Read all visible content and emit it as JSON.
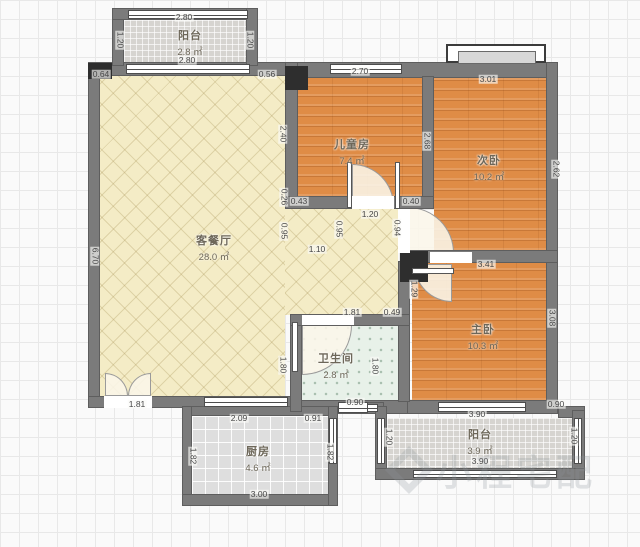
{
  "plan": {
    "title": "户型图",
    "watermark": {
      "text": "小程宅配"
    },
    "rooms": [
      {
        "name": "客餐厅",
        "area": "28.0 ㎡",
        "x": 214,
        "y": 232
      },
      {
        "name": "儿童房",
        "area": "7.4 ㎡",
        "x": 352,
        "y": 136
      },
      {
        "name": "次卧",
        "area": "10.2 ㎡",
        "x": 489,
        "y": 152
      },
      {
        "name": "主卧",
        "area": "10.3 ㎡",
        "x": 483,
        "y": 321
      },
      {
        "name": "卫生间",
        "area": "2.8 ㎡",
        "x": 336,
        "y": 350
      },
      {
        "name": "厨房",
        "area": "4.6 ㎡",
        "x": 258,
        "y": 443
      },
      {
        "name": "阳台",
        "area": "2.8 ㎡",
        "x": 190,
        "y": 27
      },
      {
        "name": "阳台",
        "area": "3.9 ㎡",
        "x": 480,
        "y": 426
      }
    ],
    "dims": [
      {
        "t": "2.80",
        "x": 184,
        "y": 17
      },
      {
        "t": "2.80",
        "x": 187,
        "y": 60
      },
      {
        "t": "1.20",
        "x": 120,
        "y": 40,
        "v": 1
      },
      {
        "t": "1.20",
        "x": 250,
        "y": 40,
        "v": 1
      },
      {
        "t": "0.64",
        "x": 101,
        "y": 74
      },
      {
        "t": "0.56",
        "x": 267,
        "y": 74
      },
      {
        "t": "2.70",
        "x": 360,
        "y": 71
      },
      {
        "t": "3.01",
        "x": 488,
        "y": 79
      },
      {
        "t": "6.70",
        "x": 95,
        "y": 256,
        "v": 1
      },
      {
        "t": "2.40",
        "x": 283,
        "y": 134,
        "v": 1
      },
      {
        "t": "2.68",
        "x": 427,
        "y": 141,
        "v": 1
      },
      {
        "t": "2.62",
        "x": 556,
        "y": 169,
        "v": 1
      },
      {
        "t": "0.43",
        "x": 299,
        "y": 201
      },
      {
        "t": "0.40",
        "x": 411,
        "y": 201
      },
      {
        "t": "1.20",
        "x": 370,
        "y": 214
      },
      {
        "t": "0.26",
        "x": 284,
        "y": 197,
        "v": 1
      },
      {
        "t": "0.95",
        "x": 284,
        "y": 231,
        "v": 1
      },
      {
        "t": "0.95",
        "x": 339,
        "y": 229,
        "v": 1
      },
      {
        "t": "1.10",
        "x": 317,
        "y": 249
      },
      {
        "t": "0.94",
        "x": 397,
        "y": 228,
        "v": 1
      },
      {
        "t": "1.29",
        "x": 414,
        "y": 289,
        "v": 1
      },
      {
        "t": "1.81",
        "x": 352,
        "y": 312
      },
      {
        "t": "0.49",
        "x": 392,
        "y": 312
      },
      {
        "t": "1.80",
        "x": 283,
        "y": 365,
        "v": 1
      },
      {
        "t": "1.80",
        "x": 375,
        "y": 366,
        "v": 1
      },
      {
        "t": "0.90",
        "x": 355,
        "y": 402
      },
      {
        "t": "0.91",
        "x": 313,
        "y": 418
      },
      {
        "t": "3.41",
        "x": 486,
        "y": 264
      },
      {
        "t": "3.08",
        "x": 552,
        "y": 318,
        "v": 1
      },
      {
        "t": "3.90",
        "x": 477,
        "y": 414
      },
      {
        "t": "3.90",
        "x": 480,
        "y": 461
      },
      {
        "t": "1.20",
        "x": 389,
        "y": 437,
        "v": 1
      },
      {
        "t": "1.20",
        "x": 574,
        "y": 436,
        "v": 1
      },
      {
        "t": "0.90",
        "x": 556,
        "y": 404
      },
      {
        "t": "1.81",
        "x": 137,
        "y": 404
      },
      {
        "t": "2.09",
        "x": 239,
        "y": 418
      },
      {
        "t": "1.82",
        "x": 193,
        "y": 456,
        "v": 1
      },
      {
        "t": "1.82",
        "x": 330,
        "y": 452,
        "v": 1
      },
      {
        "t": "3.00",
        "x": 259,
        "y": 494
      }
    ],
    "colors": {
      "wall": "#7b7b7b",
      "wood_floor": "#df8c46",
      "living_floor": "#f4ecc6",
      "bath_floor": "#e8f1e9",
      "kitchen_floor": "#dedede",
      "balcony_floor": "#d6d4d0",
      "pillar": "#2e2e2e"
    }
  }
}
